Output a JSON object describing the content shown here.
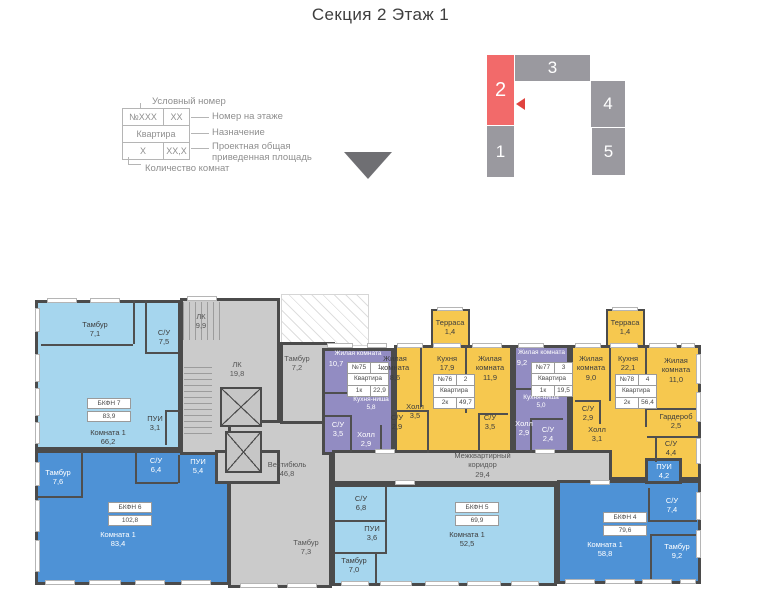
{
  "title": "Секция 2 Этаж 1",
  "legend": {
    "title": "Условный номер",
    "row1": [
      "№XXX",
      "XX"
    ],
    "row2": "Квартира",
    "row3": [
      "X",
      "XX,X"
    ],
    "notes": [
      "Номер на этаже",
      "Назначение",
      "Проектная общая приведенная площадь"
    ],
    "bottom": "Количество комнат"
  },
  "section_map": {
    "blocks": [
      "1",
      "2",
      "3",
      "4",
      "5"
    ],
    "active_block": "2"
  },
  "colors": {
    "apartment_light_blue": "#a6d6ee",
    "apartment_dark_blue": "#4e92d6",
    "apartment_purple": "#928cc2",
    "apartment_orange": "#f6c84f",
    "common_gray": "#cbcbcb",
    "active_section_red": "#f26a6a"
  },
  "plan": {
    "common_rooms": [
      {
        "name": "ЛК",
        "area": "9,9"
      },
      {
        "name": "ЛК",
        "area": "19,8"
      },
      {
        "name": "Тамбур",
        "area": "7,2"
      },
      {
        "name": "Вестибюль",
        "area": "46,8"
      },
      {
        "name": "Тамбур",
        "area": "7,3"
      },
      {
        "name": "Межквартирный коридор",
        "area": "29,4"
      }
    ],
    "apartments": [
      {
        "label": "БКФН 7",
        "area": "83,9",
        "rooms": [
          {
            "name": "Тамбур",
            "area": "7,1"
          },
          {
            "name": "С/У",
            "area": "7,5"
          },
          {
            "name": "ПУИ",
            "area": "3,1"
          },
          {
            "name": "Комната 1",
            "area": "66,2"
          }
        ]
      },
      {
        "label": "БКФН 6",
        "area": "102,8",
        "rooms": [
          {
            "name": "Тамбур",
            "area": "7,6"
          },
          {
            "name": "С/У",
            "area": "6,4"
          },
          {
            "name": "ПУИ",
            "area": "5,4"
          },
          {
            "name": "Комната 1",
            "area": "83,4"
          }
        ]
      },
      {
        "num": "№75",
        "pos": "1",
        "purpose": "Квартира",
        "rooms_count": "1к",
        "area": "22,9",
        "rooms": [
          {
            "name": "Жилая комната",
            "area": "10,7"
          },
          {
            "name": "Кухня-ниша",
            "area": "5,8"
          },
          {
            "name": "С/У",
            "area": "3,5"
          },
          {
            "name": "Холл",
            "area": "2,9"
          }
        ]
      },
      {
        "num": "№76",
        "pos": "2",
        "purpose": "Квартира",
        "rooms_count": "2к",
        "area": "49,7",
        "rooms": [
          {
            "name": "Жилая комната",
            "area": "8,6"
          },
          {
            "name": "Кухня",
            "area": "17,9"
          },
          {
            "name": "Жилая комната",
            "area": "11,9"
          },
          {
            "name": "Холл",
            "area": "3,5"
          },
          {
            "name": "С/У",
            "area": "2,9"
          },
          {
            "name": "С/У",
            "area": "3,5"
          },
          {
            "name": "Терраса",
            "area": "1,4"
          }
        ]
      },
      {
        "num": "№77",
        "pos": "3",
        "purpose": "Квартира",
        "rooms_count": "1к",
        "area": "19,5",
        "rooms": [
          {
            "name": "Жилая комната",
            "area": "9,2"
          },
          {
            "name": "Кухня-ниша",
            "area": "5,0"
          },
          {
            "name": "Холл",
            "area": "2,9"
          },
          {
            "name": "С/У",
            "area": "2,4"
          }
        ]
      },
      {
        "num": "№78",
        "pos": "4",
        "purpose": "Квартира",
        "rooms_count": "2к",
        "area": "56,4",
        "rooms": [
          {
            "name": "Жилая комната",
            "area": "9,0"
          },
          {
            "name": "Кухня",
            "area": "22,1"
          },
          {
            "name": "Жилая комната",
            "area": "11,0"
          },
          {
            "name": "С/У",
            "area": "2,9"
          },
          {
            "name": "Холл",
            "area": "3,1"
          },
          {
            "name": "Гардероб",
            "area": "2,5"
          },
          {
            "name": "С/У",
            "area": "4,4"
          },
          {
            "name": "Терраса",
            "area": "1,4"
          }
        ]
      },
      {
        "label": "БКФН 5",
        "area": "69,9",
        "rooms": [
          {
            "name": "С/У",
            "area": "6,8"
          },
          {
            "name": "ПУИ",
            "area": "3,6"
          },
          {
            "name": "Тамбур",
            "area": "7,0"
          },
          {
            "name": "Комната 1",
            "area": "52,5"
          }
        ]
      },
      {
        "label": "БКФН 4",
        "area": "79,6",
        "rooms": [
          {
            "name": "ПУИ",
            "area": "4,2"
          },
          {
            "name": "С/У",
            "area": "7,4"
          },
          {
            "name": "Тамбур",
            "area": "9,2"
          },
          {
            "name": "Комната 1",
            "area": "58,8"
          }
        ]
      }
    ]
  }
}
